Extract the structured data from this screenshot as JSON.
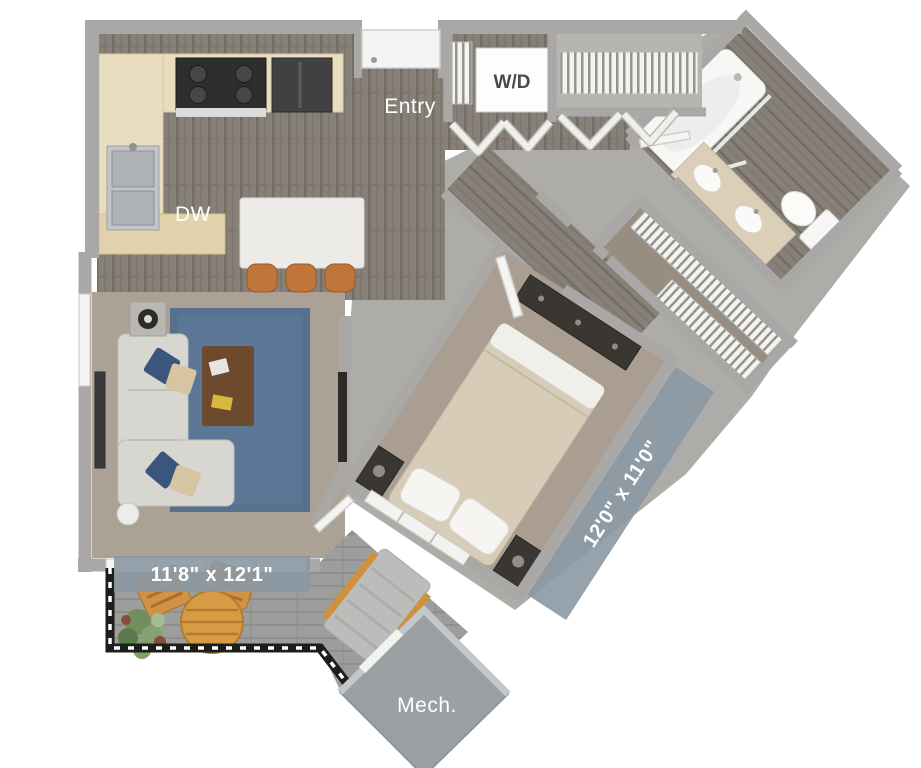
{
  "labels": {
    "entry": "Entry",
    "dishwasher": "DW",
    "washer_dryer": "W/D",
    "mechanical": "Mech."
  },
  "dimensions": {
    "living_room": "11'8\" x 12'1\"",
    "bedroom": "12'0\" x 11'0\""
  },
  "colors": {
    "dimension_band": "#8b98a3",
    "wall_gray": "#aeaca9",
    "wood_floor": "#868078",
    "carpet_living": "#aba295",
    "carpet_bedroom": "#a99e91",
    "carpet_closet": "#978d81",
    "deck_gray": "#9d9d9b",
    "rug_blue": "#56708e",
    "rug_blue_inner": "#637b9a",
    "cabinet_cream": "#e9ddbf",
    "island_white": "#ecebe7",
    "stool_orange": "#c0763a",
    "patio_wood": "#d09345",
    "mech_gray": "#9aa0a3",
    "railing_black": "#1d1d1b"
  }
}
